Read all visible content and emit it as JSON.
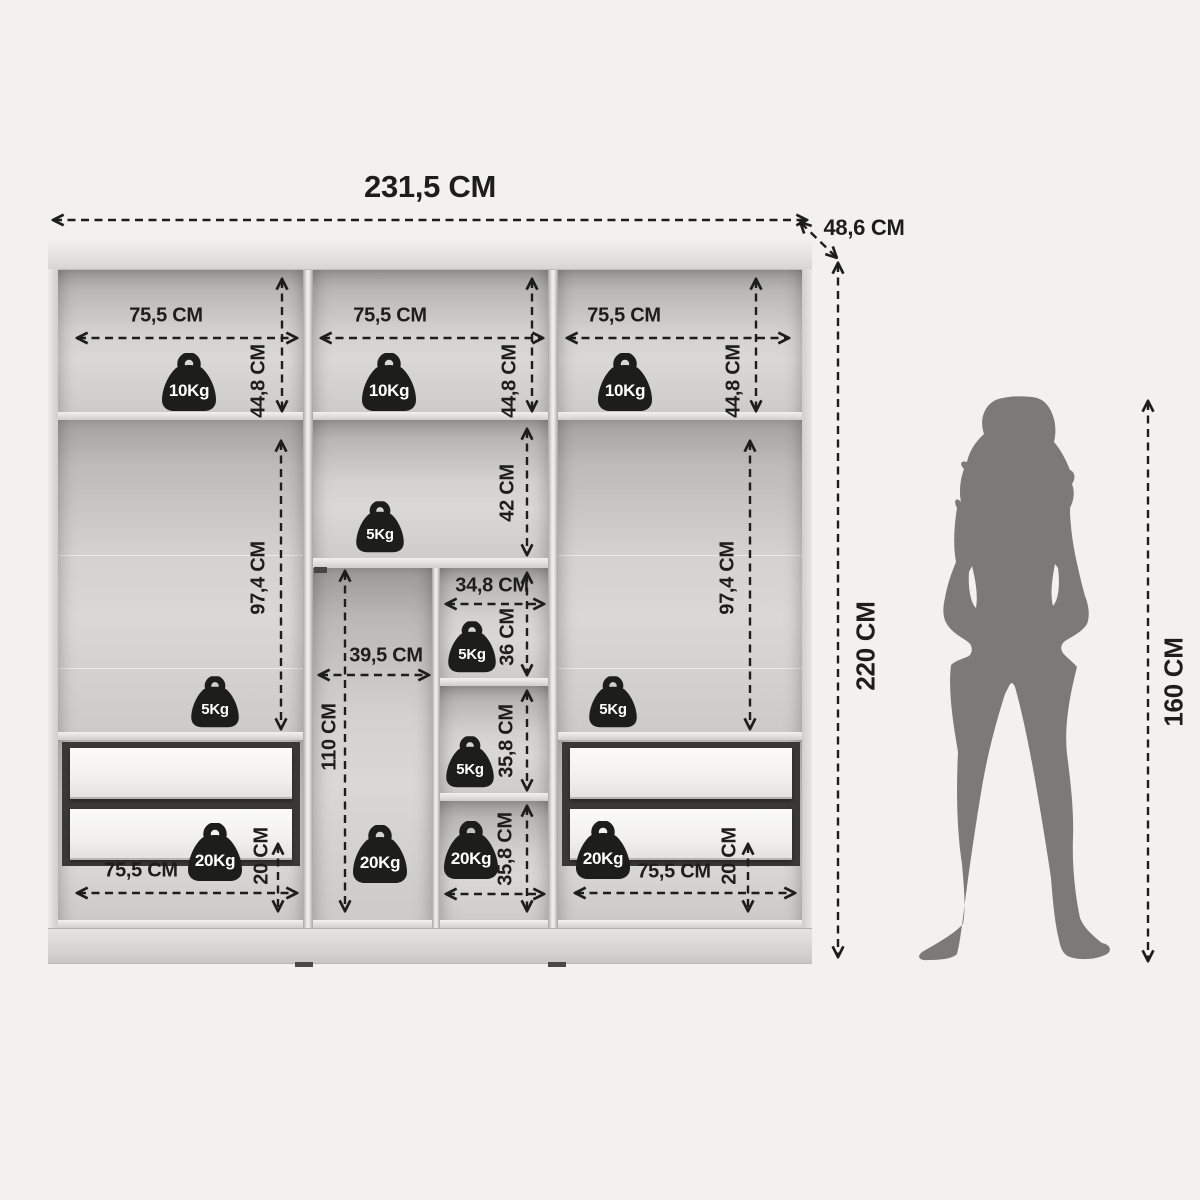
{
  "figure": {
    "overall_width": "231,5 CM",
    "depth": "48,6 CM",
    "overall_height": "220 CM",
    "person_height": "160 CM"
  },
  "top_shelves": [
    {
      "width": "75,5 CM",
      "height": "44,8 CM",
      "capacity": "10Kg"
    },
    {
      "width": "75,5 CM",
      "height": "44,8 CM",
      "capacity": "10Kg"
    },
    {
      "width": "75,5 CM",
      "height": "44,8 CM",
      "capacity": "10Kg"
    }
  ],
  "hanging_left": {
    "height": "97,4 CM",
    "capacity": "5Kg"
  },
  "hanging_right": {
    "height": "97,4 CM",
    "capacity": "5Kg"
  },
  "middle": {
    "top": {
      "height": "42 CM",
      "capacity": "5Kg"
    },
    "left": {
      "width": "39,5 CM",
      "height": "110 CM",
      "capacity": "20Kg"
    },
    "right": {
      "width": "34,8 CM",
      "cells": [
        {
          "height": "36 CM",
          "capacity": "5Kg"
        },
        {
          "height": "35,8 CM",
          "capacity": "5Kg"
        },
        {
          "height": "35,8 CM",
          "capacity": "20Kg"
        }
      ]
    }
  },
  "drawers_left": {
    "width": "75,5 CM",
    "height": "20 CM",
    "capacity": "20Kg"
  },
  "drawers_right": {
    "width": "75,5 CM",
    "height": "20 CM",
    "capacity": "20Kg"
  },
  "colors": {
    "line": "#1d1d1b",
    "silhouette": "#7b7a78"
  }
}
